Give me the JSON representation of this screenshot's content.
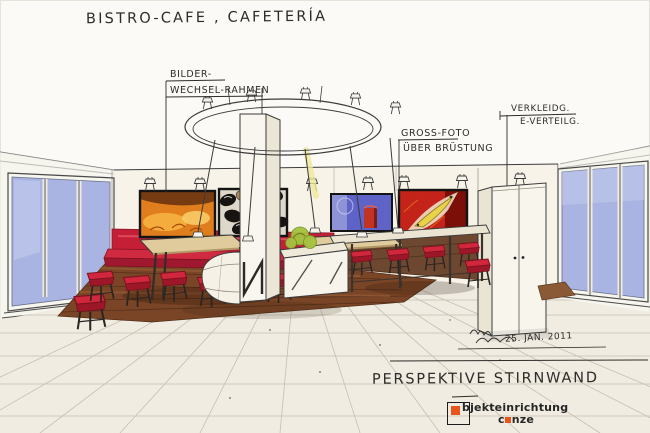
{
  "page": {
    "title": "BISTRO-CAFE , CAFETERÍA",
    "caption": "PERSPEKTIVE STIRNWAND",
    "date": "25. JAN. 2011"
  },
  "callouts": {
    "picture_frames": {
      "line1": "BILDER-",
      "line2": "WECHSEL-RAHMEN"
    },
    "large_photo": {
      "line1": "GROSS-FOTO",
      "line2": "ÜBER BRÜSTUNG"
    },
    "electrical": {
      "line1": "VERKLEIDG.",
      "line2": "E-VERTEILG."
    }
  },
  "logo": {
    "word1_rest": "bjekteinrichtung",
    "word2_pre": "c",
    "word2_post": "nze"
  },
  "colors": {
    "accent_red": "#c51f38",
    "bench_red_dark": "#9e1728",
    "wood_brown": "#7a4526",
    "wall_wood_band": "#6e4730",
    "window_blue": "#a9b4e2",
    "paper_cream": "#f7f3e9",
    "logo_orange": "#e8541d",
    "sketch_line": "#3b3b3b"
  },
  "scene_labels": {
    "panel_1": "fireplace-photo",
    "panel_2": "coffee-beans-photo",
    "panel_3": "blue-still-life-photo",
    "panel_4": "red-fruit-photo"
  }
}
